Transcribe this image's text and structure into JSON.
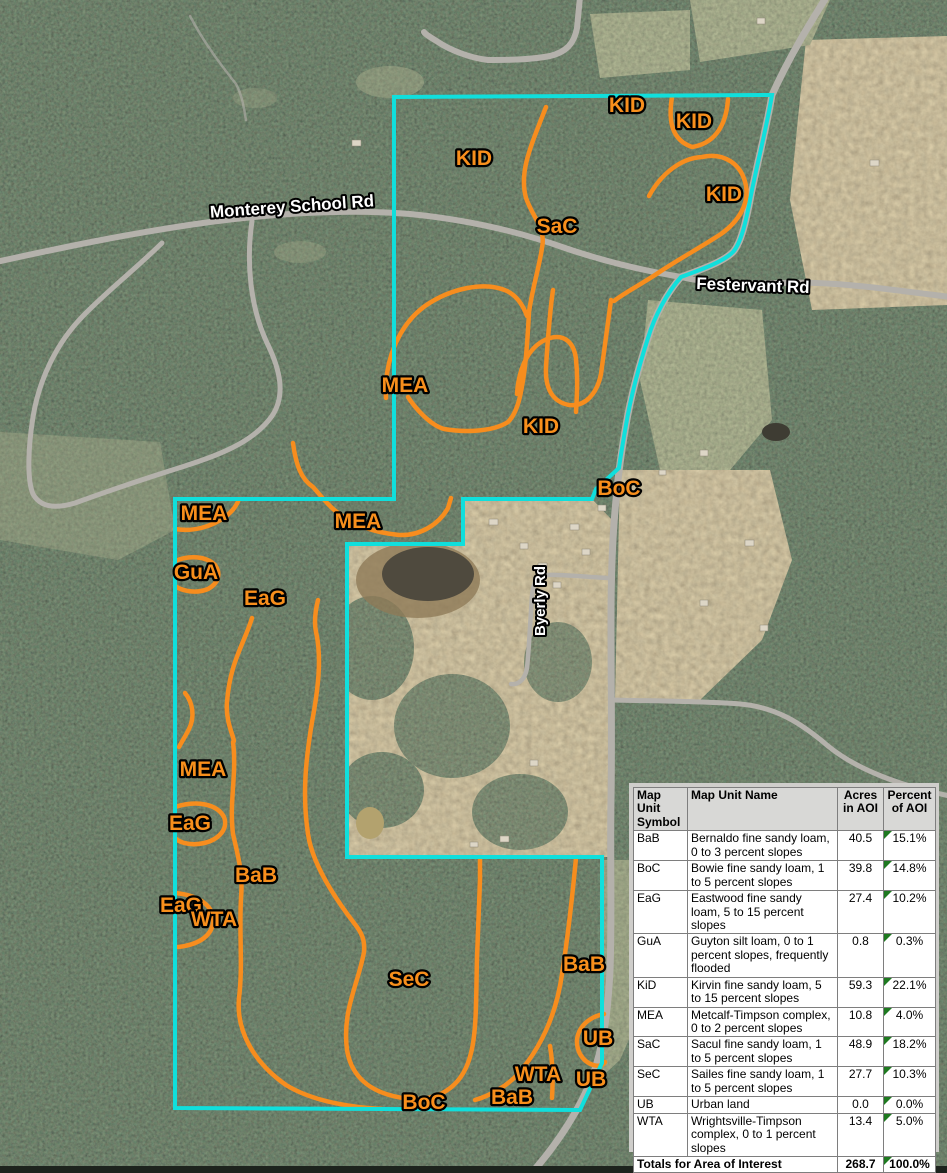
{
  "map": {
    "description": "Aerial soil survey map with area of interest outline and soil map unit delineations",
    "colors": {
      "aoi_outline": "#10dfdc",
      "soil_lines": "#f78d1e",
      "unit_label_fill": "#f88f1c",
      "roads": "#b4b1ab",
      "road_label_fill": "#ffffff"
    },
    "unit_labels": [
      {
        "text": "KID"
      },
      {
        "text": "KID"
      },
      {
        "text": "KID"
      },
      {
        "text": "KID"
      },
      {
        "text": "SaC"
      },
      {
        "text": "MEA"
      },
      {
        "text": "KID"
      },
      {
        "text": "BoC"
      },
      {
        "text": "MEA"
      },
      {
        "text": "MEA"
      },
      {
        "text": "GuA"
      },
      {
        "text": "EaG"
      },
      {
        "text": "MEA"
      },
      {
        "text": "EaG"
      },
      {
        "text": "BaB"
      },
      {
        "text": "EaG"
      },
      {
        "text": "WTA"
      },
      {
        "text": "SeC"
      },
      {
        "text": "BaB"
      },
      {
        "text": "UB"
      },
      {
        "text": "WTA"
      },
      {
        "text": "UB"
      },
      {
        "text": "BaB"
      },
      {
        "text": "BoC"
      }
    ],
    "road_labels": [
      {
        "text": "Monterey School Rd"
      },
      {
        "text": "Festervant Rd"
      },
      {
        "text": "Byerly Rd"
      }
    ]
  },
  "legend_table": {
    "headers": {
      "symbol": "Map Unit Symbol",
      "name": "Map Unit Name",
      "acres": "Acres in AOI",
      "percent": "Percent of AOI"
    },
    "rows": [
      {
        "symbol": "BaB",
        "name": "Bernaldo fine sandy loam, 0 to 3 percent slopes",
        "acres": "40.5",
        "percent": "15.1%"
      },
      {
        "symbol": "BoC",
        "name": "Bowie fine sandy loam, 1 to 5 percent slopes",
        "acres": "39.8",
        "percent": "14.8%"
      },
      {
        "symbol": "EaG",
        "name": "Eastwood fine sandy loam, 5 to 15 percent slopes",
        "acres": "27.4",
        "percent": "10.2%"
      },
      {
        "symbol": "GuA",
        "name": "Guyton silt loam, 0 to 1 percent slopes, frequently flooded",
        "acres": "0.8",
        "percent": "0.3%"
      },
      {
        "symbol": "KiD",
        "name": "Kirvin fine sandy loam, 5 to 15 percent slopes",
        "acres": "59.3",
        "percent": "22.1%"
      },
      {
        "symbol": "MEA",
        "name": "Metcalf-Timpson complex, 0 to 2 percent slopes",
        "acres": "10.8",
        "percent": "4.0%"
      },
      {
        "symbol": "SaC",
        "name": "Sacul fine sandy loam, 1 to 5 percent slopes",
        "acres": "48.9",
        "percent": "18.2%"
      },
      {
        "symbol": "SeC",
        "name": "Sailes fine sandy loam, 1 to 5 percent slopes",
        "acres": "27.7",
        "percent": "10.3%"
      },
      {
        "symbol": "UB",
        "name": "Urban land",
        "acres": "0.0",
        "percent": "0.0%"
      },
      {
        "symbol": "WTA",
        "name": "Wrightsville-Timpson complex, 0 to 1 percent slopes",
        "acres": "13.4",
        "percent": "5.0%"
      }
    ],
    "totals": {
      "label": "Totals for Area of Interest",
      "acres": "268.7",
      "percent": "100.0%"
    }
  }
}
